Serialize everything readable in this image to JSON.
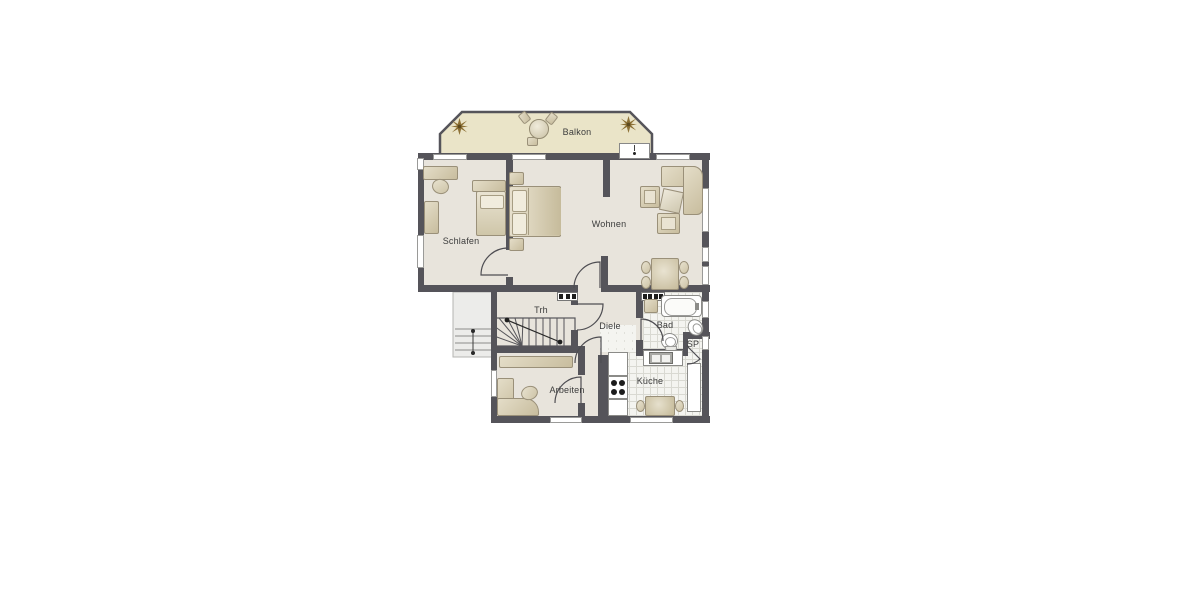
{
  "rooms": {
    "balkon": {
      "label": "Balkon"
    },
    "schlafen": {
      "label": "Schlafen"
    },
    "wohnen": {
      "label": "Wohnen"
    },
    "trh": {
      "label": "Trh"
    },
    "diele": {
      "label": "Diele"
    },
    "bad": {
      "label": "Bad"
    },
    "sp": {
      "label": "SP"
    },
    "arbeiten": {
      "label": "Arbeiten"
    },
    "kueche": {
      "label": "Küche"
    }
  },
  "colors": {
    "background": "#ffffff",
    "wall": "#55545a",
    "floor": "#e8e4dc",
    "balcony_floor": "#eae4c8",
    "tile": "#f4f4f0",
    "tile_line": "#d9d9d2",
    "furniture_light": "#e4ddc8",
    "furniture_dark": "#c8bd9e",
    "furniture_border": "#9a9079",
    "fixture_white": "#ffffff",
    "fixture_border": "#8b8b88",
    "label_text": "#3c3c3c",
    "plant": "#8d7136",
    "door_line": "#4e4d52"
  }
}
